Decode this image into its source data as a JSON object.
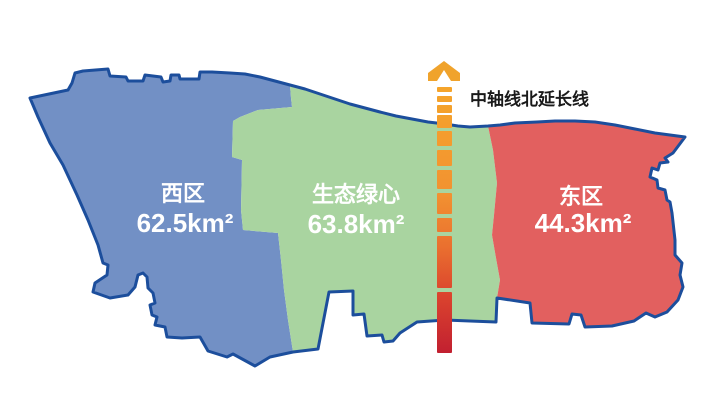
{
  "regions": [
    {
      "name": "西区",
      "area": "62.5km²",
      "color": "#7290C5"
    },
    {
      "name": "生态绿心",
      "area": "63.8km²",
      "color": "#A9D4A0"
    },
    {
      "name": "东区",
      "area": "44.3km²",
      "color": "#E2605F"
    }
  ],
  "axis": {
    "label": "中轴线北延长线",
    "arrow_color": "#F0A32C",
    "gradient": [
      "#F5A52B",
      "#F29231",
      "#EA702F",
      "#DB442E",
      "#C22030"
    ]
  },
  "colors": {
    "outline": "#1C4E9C",
    "label_text": "#FFFFFF",
    "axis_label_text": "#1A1A1A",
    "background": "#FFFFFF"
  }
}
